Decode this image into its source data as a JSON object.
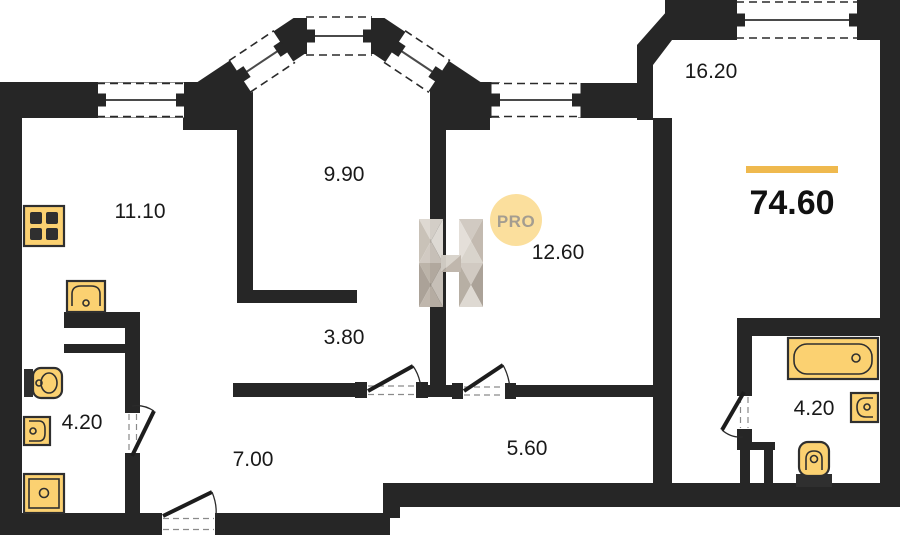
{
  "plan": {
    "room_areas": [
      "11.10",
      "9.90",
      "12.60",
      "16.20",
      "3.80",
      "4.20",
      "7.00",
      "5.60",
      "4.20"
    ],
    "total": {
      "area": "74.60"
    },
    "logo": {
      "pro_label": "PRO"
    },
    "colors": {
      "wall": "#262626",
      "fixture_fill": "#fbd171",
      "fixture_stroke": "#2f2f2f",
      "accent_bar": "#efb94e",
      "logo_circle": "#fbdf9d",
      "logo_text": "#a49d90",
      "label_text": "#191919"
    }
  }
}
